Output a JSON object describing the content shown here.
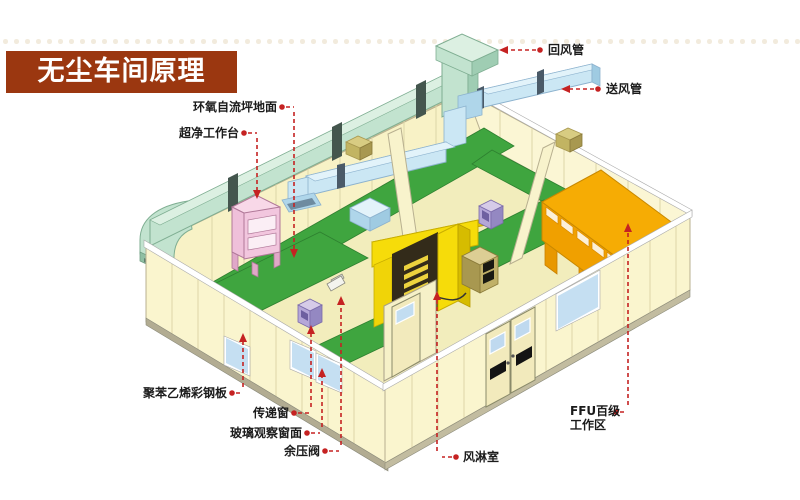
{
  "banner": {
    "title": "无尘车间原理",
    "bg_color": "#9b3710",
    "text_color": "#ffffff"
  },
  "diagram": {
    "labels": {
      "return_duct": "回风管",
      "supply_duct": "送风管",
      "epoxy_floor": "环氧自流坪地面",
      "clean_bench": "超净工作台",
      "steel_panel": "聚苯乙烯彩钢板",
      "transfer_window": "传递窗",
      "glass_window": "玻璃观察窗面",
      "pressure_valve": "余压阀",
      "air_shower": "风淋室",
      "ffu_line1": "FFU百级",
      "ffu_line2": "工作区"
    },
    "colors": {
      "leader_red": "#c52222",
      "wall_cream": "#faf5ce",
      "floor_green": "#3fa53f",
      "return_duct_green": "#c2e3cf",
      "supply_duct_blue": "#cbe7f4",
      "air_shower_yellow": "#f6dc0a",
      "ffu_orange": "#f6ac04",
      "bench_pink": "#f2c6de",
      "pass_box_purple": "#b5a7d8"
    }
  }
}
